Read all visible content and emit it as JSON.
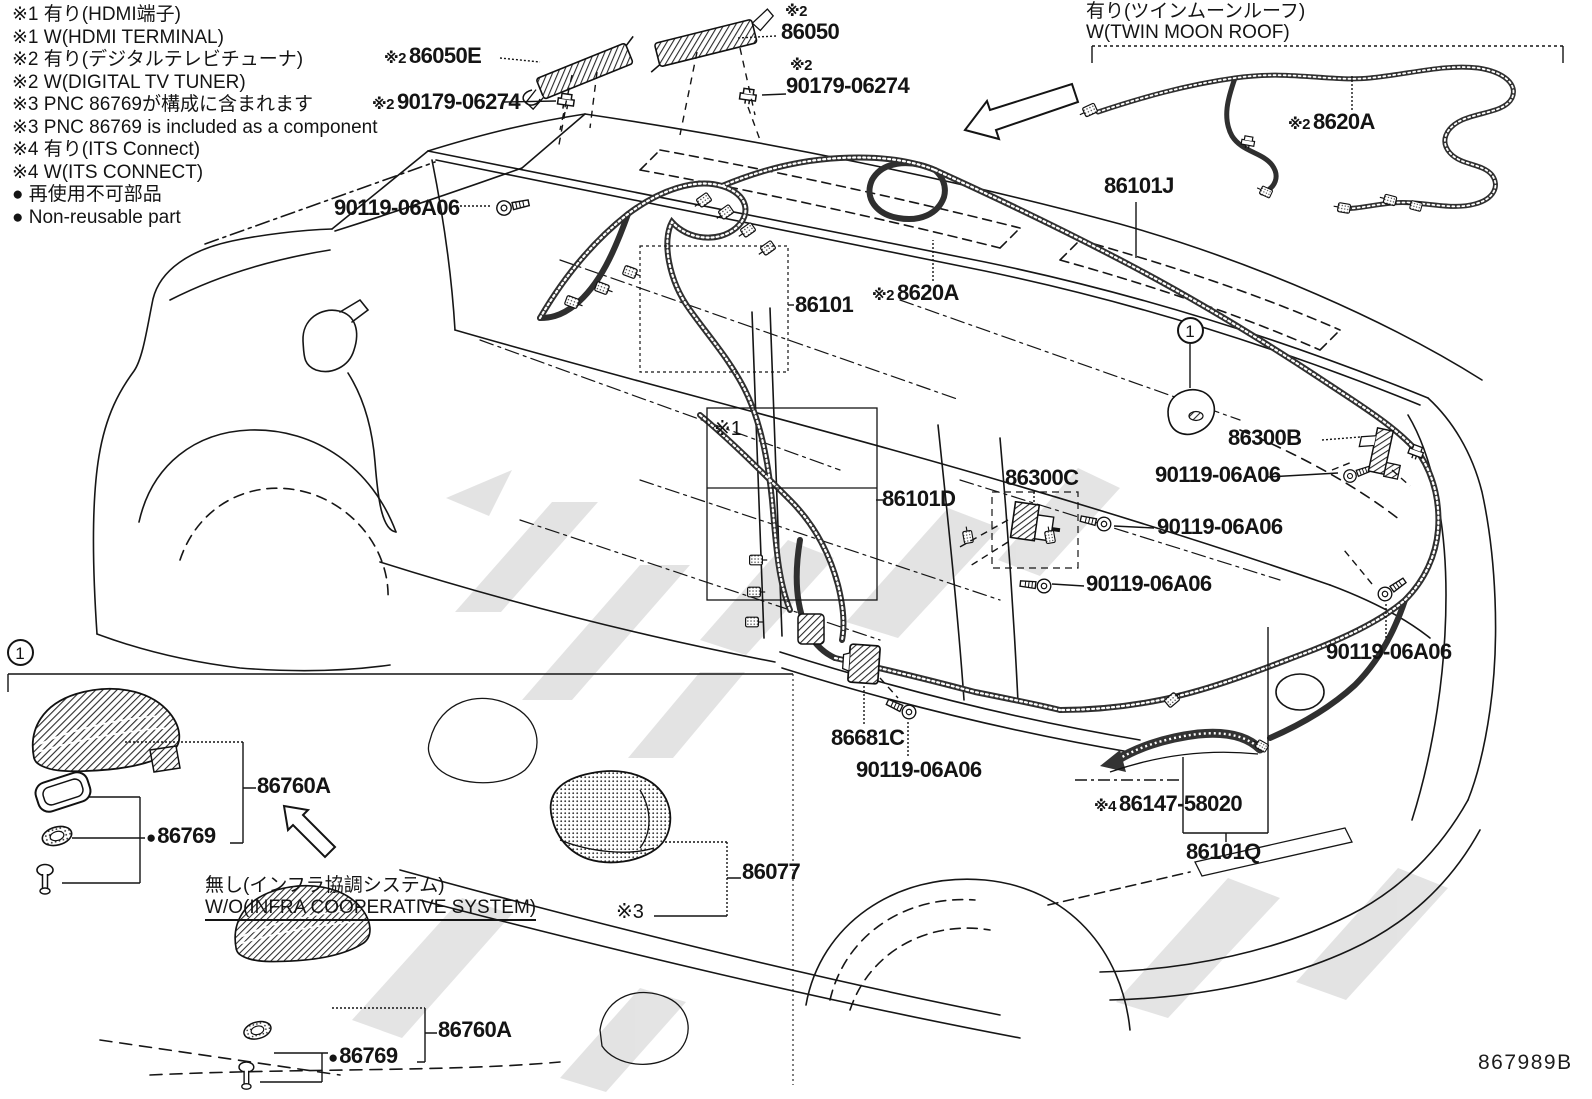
{
  "page": {
    "width": 1592,
    "height": 1099,
    "background": "#ffffff",
    "ink_color": "#141414",
    "harness_color": "#2f2f2f",
    "watermark_color": "#c9c9c9",
    "drawing_code": "867989B"
  },
  "legend": {
    "items": [
      "※1 有り(HDMI端子)",
      "※1 W(HDMI TERMINAL)",
      "※2 有り(デジタルテレビチューナ)",
      "※2 W(DIGITAL TV TUNER)",
      "※3 PNC 86769が構成に含まれます",
      "※3 PNC 86769 is included as a component",
      "※4 有り(ITS  Connect)",
      "※4 W(ITS CONNECT)",
      "● 再使用不可部品",
      "● Non-reusable part"
    ]
  },
  "callouts": [
    {
      "kind": "part",
      "prefix": "※2",
      "text": "86050E",
      "x": 384,
      "y": 44
    },
    {
      "kind": "part",
      "prefix": "※2",
      "text": "86050",
      "x": 781,
      "y": 4,
      "stacked": true
    },
    {
      "kind": "part",
      "prefix": "※2",
      "text": "90179-06274",
      "x": 372,
      "y": 90
    },
    {
      "kind": "part",
      "prefix": "※2",
      "text": "90179-06274",
      "x": 786,
      "y": 58,
      "stacked": true
    },
    {
      "kind": "part",
      "text": "90119-06A06",
      "x": 334,
      "y": 196
    },
    {
      "kind": "part",
      "text": "86101",
      "x": 795,
      "y": 293
    },
    {
      "kind": "part",
      "prefix": "※2",
      "text": "8620A",
      "x": 872,
      "y": 281
    },
    {
      "kind": "part",
      "text": "86101J",
      "x": 1104,
      "y": 174
    },
    {
      "kind": "part",
      "prefix": "※2",
      "text": "8620A",
      "x": 1288,
      "y": 110
    },
    {
      "kind": "part",
      "text": "86300B",
      "x": 1228,
      "y": 426
    },
    {
      "kind": "part",
      "text": "90119-06A06",
      "x": 1155,
      "y": 463
    },
    {
      "kind": "part",
      "text": "86300C",
      "x": 1005,
      "y": 466
    },
    {
      "kind": "part",
      "text": "86101D",
      "x": 882,
      "y": 487
    },
    {
      "kind": "part",
      "text": "90119-06A06",
      "x": 1157,
      "y": 515
    },
    {
      "kind": "part",
      "text": "90119-06A06",
      "x": 1086,
      "y": 572
    },
    {
      "kind": "part",
      "text": "90119-06A06",
      "x": 1326,
      "y": 640
    },
    {
      "kind": "part",
      "text": "86681C",
      "x": 831,
      "y": 726
    },
    {
      "kind": "part",
      "text": "90119-06A06",
      "x": 856,
      "y": 758
    },
    {
      "kind": "part",
      "prefix": "※4",
      "text": "86147-58020",
      "x": 1094,
      "y": 792
    },
    {
      "kind": "part",
      "text": "86101Q",
      "x": 1186,
      "y": 840
    },
    {
      "kind": "part",
      "text": "86760A",
      "x": 257,
      "y": 774
    },
    {
      "kind": "part",
      "text": "86769",
      "bullet": true,
      "x": 146,
      "y": 824
    },
    {
      "kind": "part",
      "text": "86760A",
      "x": 438,
      "y": 1018
    },
    {
      "kind": "part",
      "text": "86769",
      "bullet": true,
      "x": 328,
      "y": 1044
    },
    {
      "kind": "part",
      "text": "86077",
      "x": 742,
      "y": 860
    },
    {
      "kind": "ref",
      "text": "※3",
      "x": 616,
      "y": 902
    },
    {
      "kind": "ref",
      "text": "※1",
      "x": 714,
      "y": 419
    },
    {
      "kind": "note",
      "text": "有り(ツインムーンルーフ)",
      "x": 1086,
      "y": 2
    },
    {
      "kind": "note",
      "text": "W(TWIN MOON ROOF)",
      "x": 1086,
      "y": 23
    },
    {
      "kind": "note",
      "text": "無し(インフラ協調システム)",
      "x": 205,
      "y": 876
    },
    {
      "kind": "note",
      "text": "W/O(INFRA COOPERATIVE SYSTEM)",
      "x": 205,
      "y": 898,
      "underline": true
    },
    {
      "kind": "code",
      "text": "867989B",
      "x": 1478,
      "y": 1052
    }
  ],
  "markers": [
    {
      "value": "1",
      "x": 1190,
      "y": 330
    },
    {
      "value": "1",
      "x": 20,
      "y": 652
    }
  ]
}
